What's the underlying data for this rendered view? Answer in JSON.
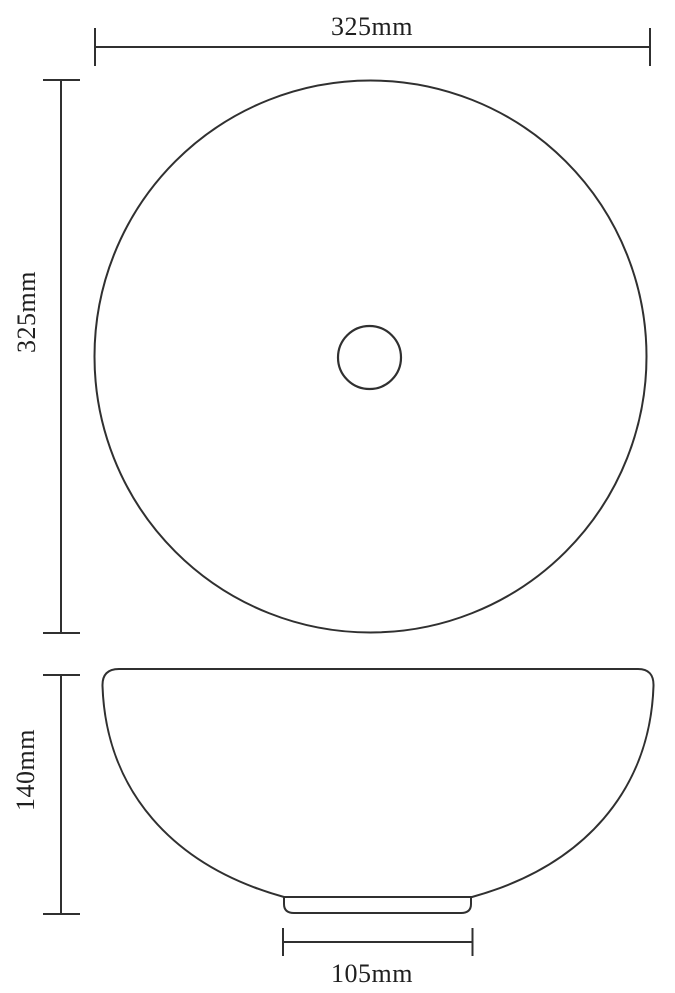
{
  "drawing": {
    "kind": "technical-dimension-drawing",
    "views": {
      "top_view": "round basin seen from above with central drain hole",
      "side_view": "bowl profile with flat base foot"
    },
    "dimensions": {
      "width": "325mm",
      "depth": "325mm",
      "height": "140mm",
      "base_width": "105mm"
    },
    "colors": {
      "line": "#303030",
      "text": "#1f1f1f",
      "background": "#ffffff"
    }
  }
}
